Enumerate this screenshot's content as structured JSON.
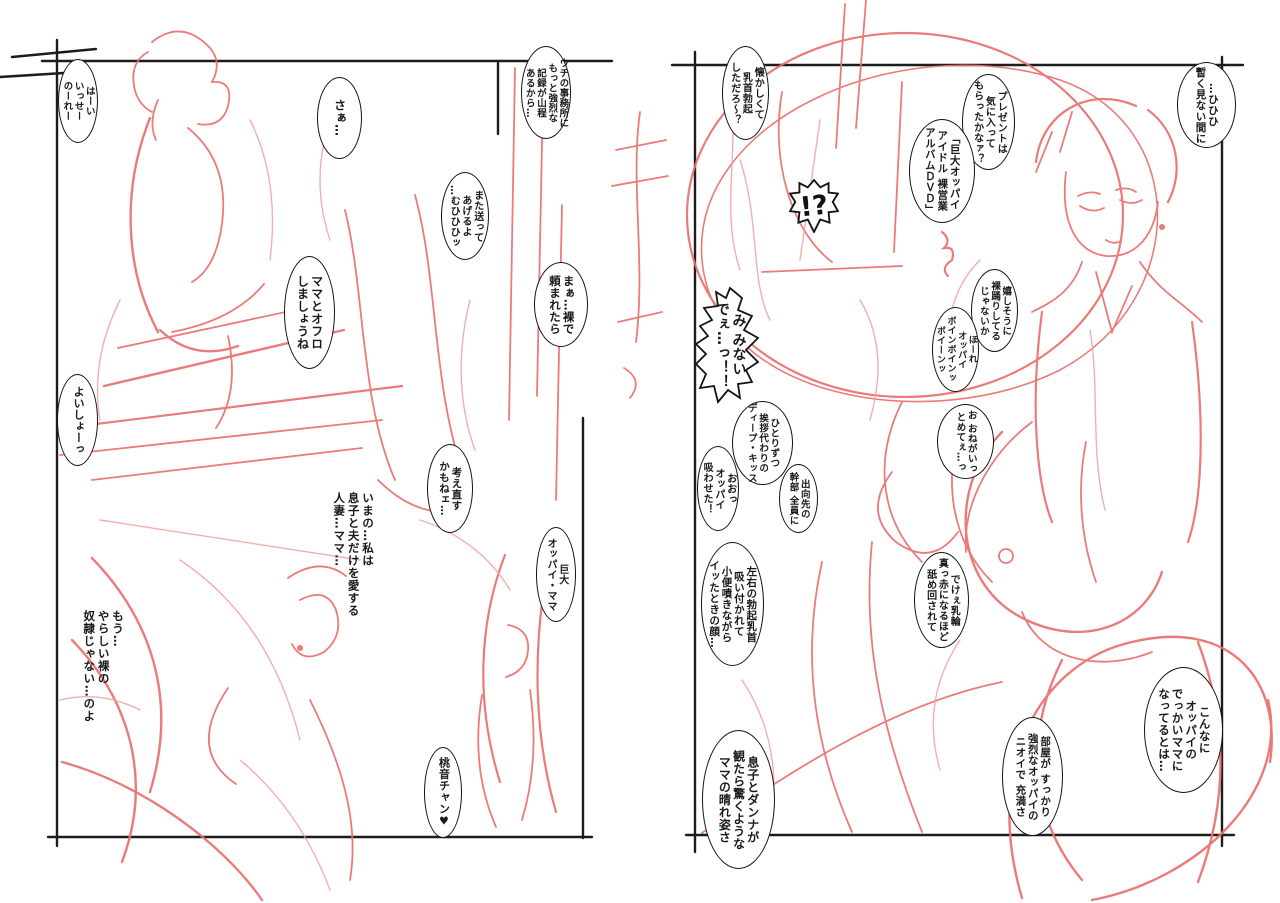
{
  "meta": {
    "kind": "manga-rough-sketch-two-page-spread",
    "background": "#ffffff",
    "ink_color": "#141414",
    "sketch_red": "#e9706e",
    "sketch_red_light": "#f2a0a0"
  },
  "left_page": {
    "bubbles": [
      {
        "id": "haai",
        "text": "はーい\nいっせー\nのーれー"
      },
      {
        "id": "saa",
        "text": "さぁ…"
      },
      {
        "id": "uchi",
        "text": "ウチの事務所に\nもっと強烈な\n記録が山程\nあるから…"
      },
      {
        "id": "mata",
        "text": "また送って\nあげるよ\n…むひひひッ"
      },
      {
        "id": "maa",
        "text": "まぁ…裸で\n頼まれたら"
      },
      {
        "id": "ofuro",
        "text": "ママとオフロ\nしましょうね"
      },
      {
        "id": "yoisho",
        "text": "よいしょーっ"
      },
      {
        "id": "kangae",
        "text": "考え直す\nかもねェ…"
      },
      {
        "id": "kyodai",
        "text": "巨大\nオッパイ・ママ"
      },
      {
        "id": "momone",
        "text": "桃音チャン♥"
      }
    ],
    "texts": [
      {
        "id": "imano",
        "text": "いまの…私は\n息子と夫だけを愛する\n人妻…ママ…"
      },
      {
        "id": "mou",
        "text": "もう…\nやらしい裸の\n奴隷じゃない…のよ"
      }
    ]
  },
  "right_page": {
    "bubbles": [
      {
        "id": "natsukashi",
        "text": "懐かしくて\n乳首勃起\nしただろ～？"
      },
      {
        "id": "present",
        "text": "プレゼントは\n気に入って\nもらったかなァ？"
      },
      {
        "id": "dvd",
        "text": "「巨大オッパイ\nアイドル 裸営業\nアルバムＤＶＤ」"
      },
      {
        "id": "hihihi",
        "text": "…ひひひ\n暫く見ない間に"
      },
      {
        "id": "ureshi",
        "text": "嬉しそうに\n裸踊りしてる\nじゃないか"
      },
      {
        "id": "hore",
        "text": "ほーれ\nオッパイ\nボインボインッ\nボイーンッ"
      },
      {
        "id": "onegai",
        "text": "お おねがいっ\nとめてぇ…っ"
      },
      {
        "id": "hitorizutsu",
        "text": "ひとりずつ\n挨拶代わりの\nディープ・キッス"
      },
      {
        "id": "shukko",
        "text": "出向先の\n幹部 全員に"
      },
      {
        "id": "suwaseta",
        "text": "おおっ\nオッパイ\n吸わせた！"
      },
      {
        "id": "sayuu",
        "text": "左右の勃起乳首\n吸い付かれて\n小便噴きながら\nイッたときの顔…"
      },
      {
        "id": "dekee",
        "text": "でけぇ乳輪\n真っ赤になるほど\n舐め回されて"
      },
      {
        "id": "konnani",
        "text": "こんなに\nオッパイの\nでっかいママに\nなってるとは…"
      },
      {
        "id": "heya",
        "text": "部屋が すっかり\n強烈なオッパイの\nニオイで 充満さ"
      },
      {
        "id": "musuko",
        "text": "息子とダンナが\n観たら驚くような\nママの晴れ姿さ"
      }
    ],
    "shouts": [
      {
        "id": "bang",
        "text": "!?"
      },
      {
        "id": "minaide",
        "text": "み みない\nでぇ…っ！！"
      }
    ]
  }
}
